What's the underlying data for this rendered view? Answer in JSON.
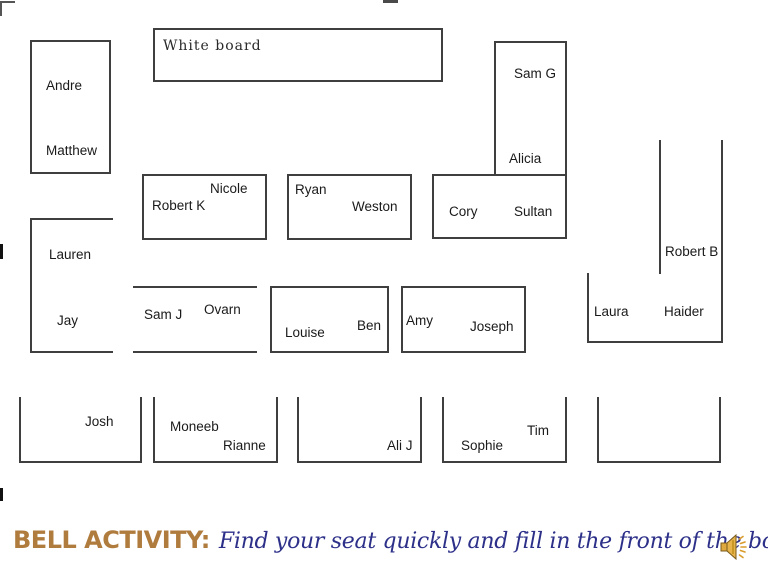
{
  "slide": {
    "whiteboard_label": "White board",
    "seats": {
      "andre": "Andre",
      "matthew": "Matthew",
      "sam_g": "Sam G",
      "alicia": "Alicia",
      "nicole": "Nicole",
      "robert_k": "Robert K",
      "ryan": "Ryan",
      "weston": "Weston",
      "cory": "Cory",
      "sultan": "Sultan",
      "robert_b": "Robert B",
      "lauren": "Lauren",
      "jay": "Jay",
      "sam_j": "Sam J",
      "ovarn": "Ovarn",
      "louise": "Louise",
      "ben": "Ben",
      "amy": "Amy",
      "joseph": "Joseph",
      "laura": "Laura",
      "haider": "Haider",
      "josh": "Josh",
      "moneeb": "Moneeb",
      "rianne": "Rianne",
      "ali_j": "Ali J",
      "sophie": "Sophie",
      "tim": "Tim"
    },
    "footer": {
      "bell_label": "BELL ACTIVITY:",
      "message": "Find your seat quickly and fill in the front of the book!"
    },
    "icons": {
      "speaker": "speaker-sound-icon"
    },
    "colors": {
      "line": "#3f3f3f",
      "name_text": "#1a1a1a",
      "bell_label": "#b07c3e",
      "message_text": "#2d3089",
      "speaker_gold": "#dfa93e"
    }
  }
}
